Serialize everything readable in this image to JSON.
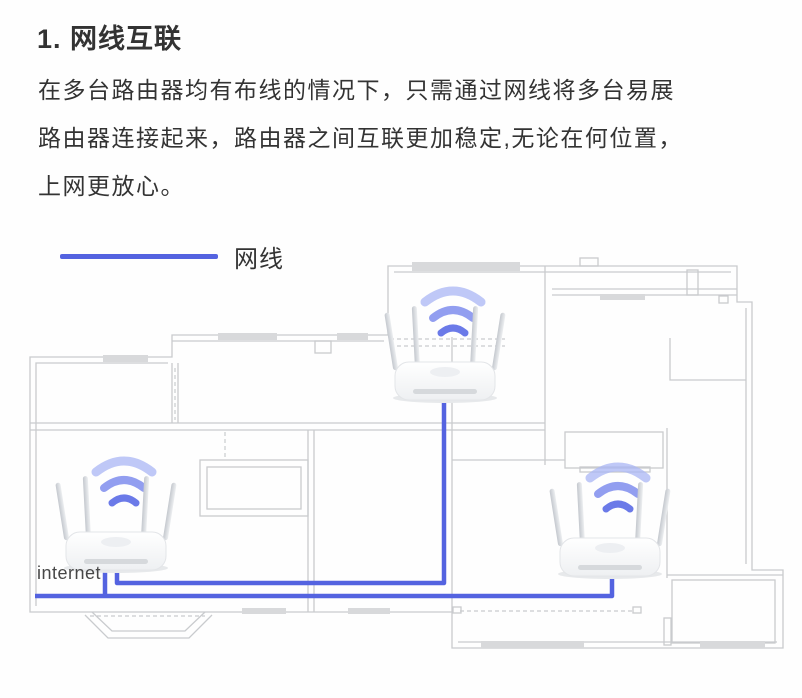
{
  "page": {
    "title": "1. 网线互联",
    "paragraph": [
      "在多台路由器均有布线的情况下，只需通过网线将多台易展",
      "路由器连接起来，路由器之间互联更加稳定,无论在何位置，",
      "上网更放心。"
    ],
    "legend": {
      "label": "网线"
    },
    "diagram": {
      "internet_label": "internet",
      "routers": [
        "top-room-router",
        "internet-router",
        "bottom-right-router"
      ]
    }
  },
  "colors": {
    "text": "#333333",
    "cable": "#5463e0",
    "wall": "#c9cbce",
    "window-fill": "#d8d9db",
    "wifi-strong": "#6b7ae8",
    "wifi-mid": "#8694ee",
    "wifi-light": "#aab6f4"
  }
}
